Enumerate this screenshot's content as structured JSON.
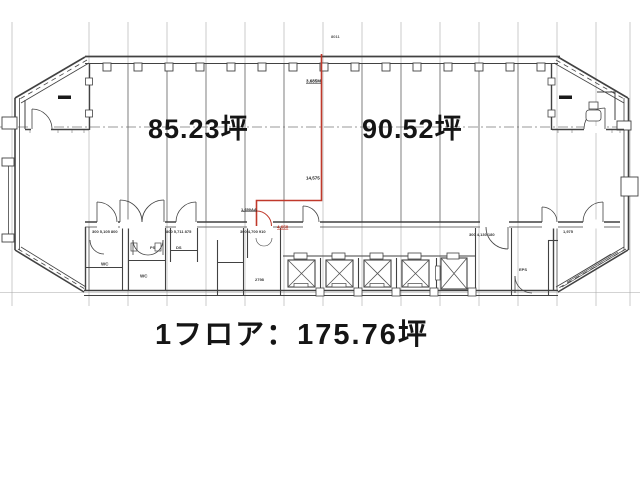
{
  "page": {
    "background": "#ffffff",
    "kind": "architectural floor plan scan"
  },
  "colors": {
    "line": "#424242",
    "grid": "#a0a0a0",
    "division_line": "#c0392b",
    "text": "#151515"
  },
  "labels": {
    "left_area": "85.23坪",
    "right_area": "90.52坪",
    "total_area": "1フロア：175.76坪"
  },
  "annotations": [
    {
      "text": "8011",
      "x": 331,
      "y": 35,
      "size": 4,
      "color": "#555555",
      "underline": false
    },
    {
      "text": "3,685M",
      "x": 306,
      "y": 79,
      "size": 4.5,
      "color": "#1a1a1a",
      "underline": true
    },
    {
      "text": "14,575",
      "x": 306,
      "y": 176,
      "size": 4.5,
      "color": "#1a1a1a",
      "underline": false
    },
    {
      "text": "1,650AA",
      "x": 241,
      "y": 208,
      "size": 4,
      "color": "#1a1a1a",
      "underline": true
    },
    {
      "text": "4,650",
      "x": 277,
      "y": 225,
      "size": 4.5,
      "color": "#c0392b",
      "underline": true
    },
    {
      "text": "300  5,105  800",
      "x": 92,
      "y": 230,
      "size": 4,
      "color": "#333333",
      "underline": false
    },
    {
      "text": "800  5,711  875",
      "x": 166,
      "y": 230,
      "size": 4,
      "color": "#333333",
      "underline": false
    },
    {
      "text": "300  4,700  910",
      "x": 240,
      "y": 230,
      "size": 4,
      "color": "#333333",
      "underline": false
    },
    {
      "text": "300  4,130  180",
      "x": 469,
      "y": 233,
      "size": 4,
      "color": "#333333",
      "underline": false
    },
    {
      "text": "1,975",
      "x": 563,
      "y": 230,
      "size": 4,
      "color": "#333333",
      "underline": false
    },
    {
      "text": "WC",
      "x": 101,
      "y": 262,
      "size": 4.5,
      "color": "#333333",
      "underline": false
    },
    {
      "text": "WC",
      "x": 140,
      "y": 274,
      "size": 4.5,
      "color": "#333333",
      "underline": false
    },
    {
      "text": "PS",
      "x": 150,
      "y": 246,
      "size": 4,
      "color": "#333333",
      "underline": false
    },
    {
      "text": "DS",
      "x": 176,
      "y": 246,
      "size": 4,
      "color": "#333333",
      "underline": false
    },
    {
      "text": "2798",
      "x": 255,
      "y": 278,
      "size": 4,
      "color": "#333333",
      "underline": false
    },
    {
      "text": "EPS",
      "x": 519,
      "y": 268,
      "size": 4,
      "color": "#333333",
      "underline": false
    }
  ]
}
